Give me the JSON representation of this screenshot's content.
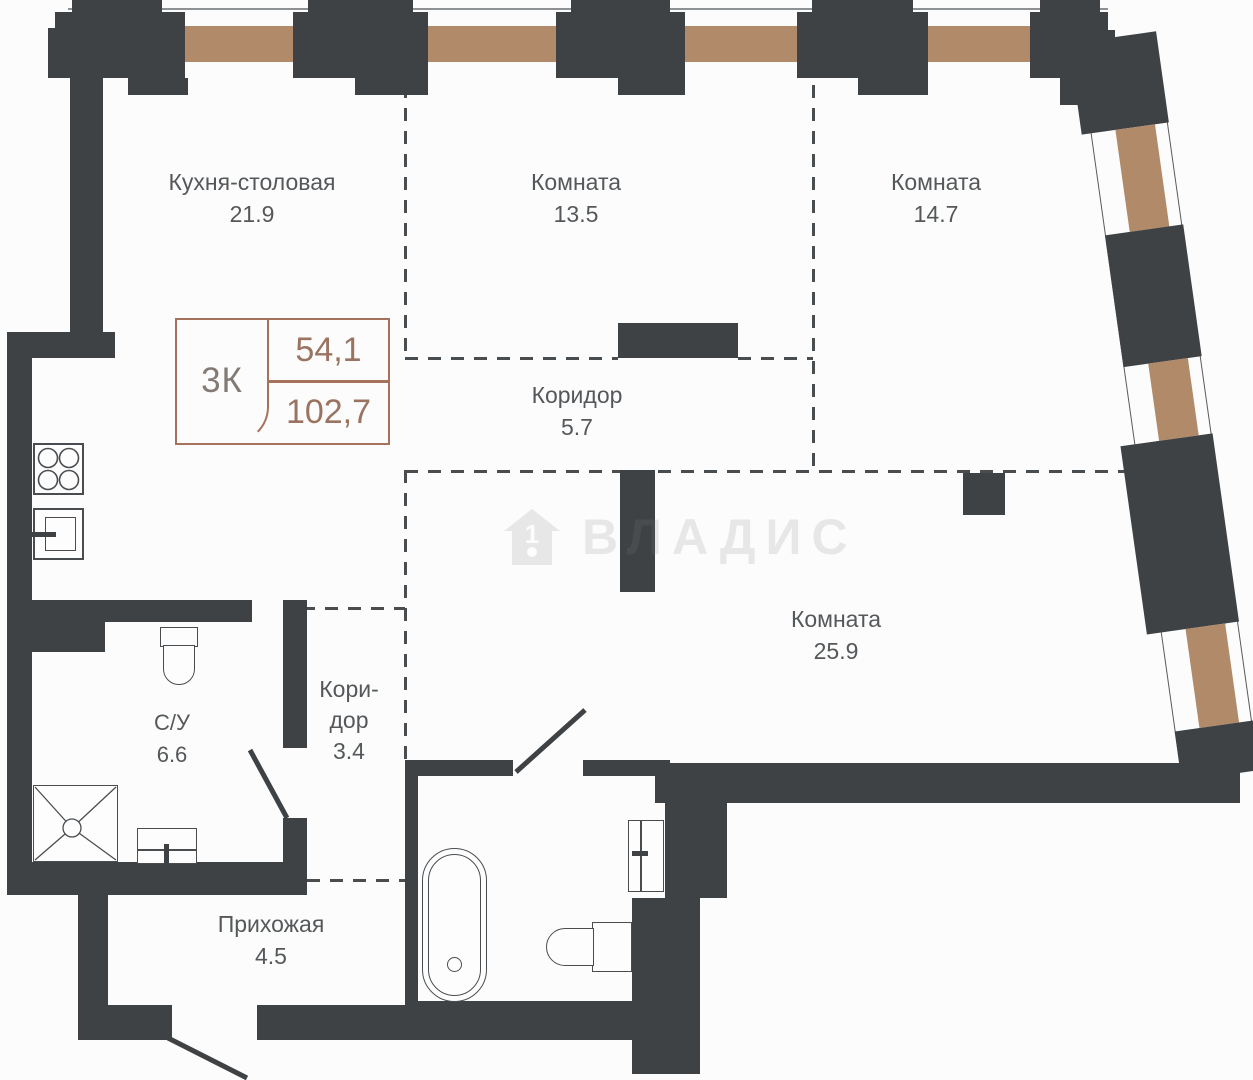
{
  "plan": {
    "unit_info": {
      "type_label": "3К",
      "area_living": "54,1",
      "area_total": "102,7"
    },
    "watermark": {
      "brand": "ВЛАДИС",
      "icon": "house-number-1-icon"
    },
    "rooms": [
      {
        "id": "kitchen",
        "name": "Кухня-столовая",
        "area": "21.9"
      },
      {
        "id": "room-13",
        "name": "Комната",
        "area": "13.5"
      },
      {
        "id": "room-14",
        "name": "Комната",
        "area": "14.7"
      },
      {
        "id": "corridor-5",
        "name": "Коридор",
        "area": "5.7"
      },
      {
        "id": "room-25",
        "name": "Комната",
        "area": "25.9"
      },
      {
        "id": "bathroom",
        "name": "С/У",
        "area": "6.6"
      },
      {
        "id": "corridor-3",
        "name": "Коридор",
        "area": "3.4",
        "name_lines": [
          "Кори-",
          "дор"
        ]
      },
      {
        "id": "hallway",
        "name": "Прихожая",
        "area": "4.5"
      }
    ],
    "colors": {
      "wall": "#3e4245",
      "window_beam": "#b18a69",
      "accent": "#a5735b",
      "label_text": "#55585a",
      "number_text": "#9b7361",
      "type_text": "#837a76",
      "dash": "#4a4d50",
      "fixture": "#4a4d50",
      "watermark": "rgba(128,128,128,0.17)",
      "background": "#fcfcfc"
    }
  }
}
